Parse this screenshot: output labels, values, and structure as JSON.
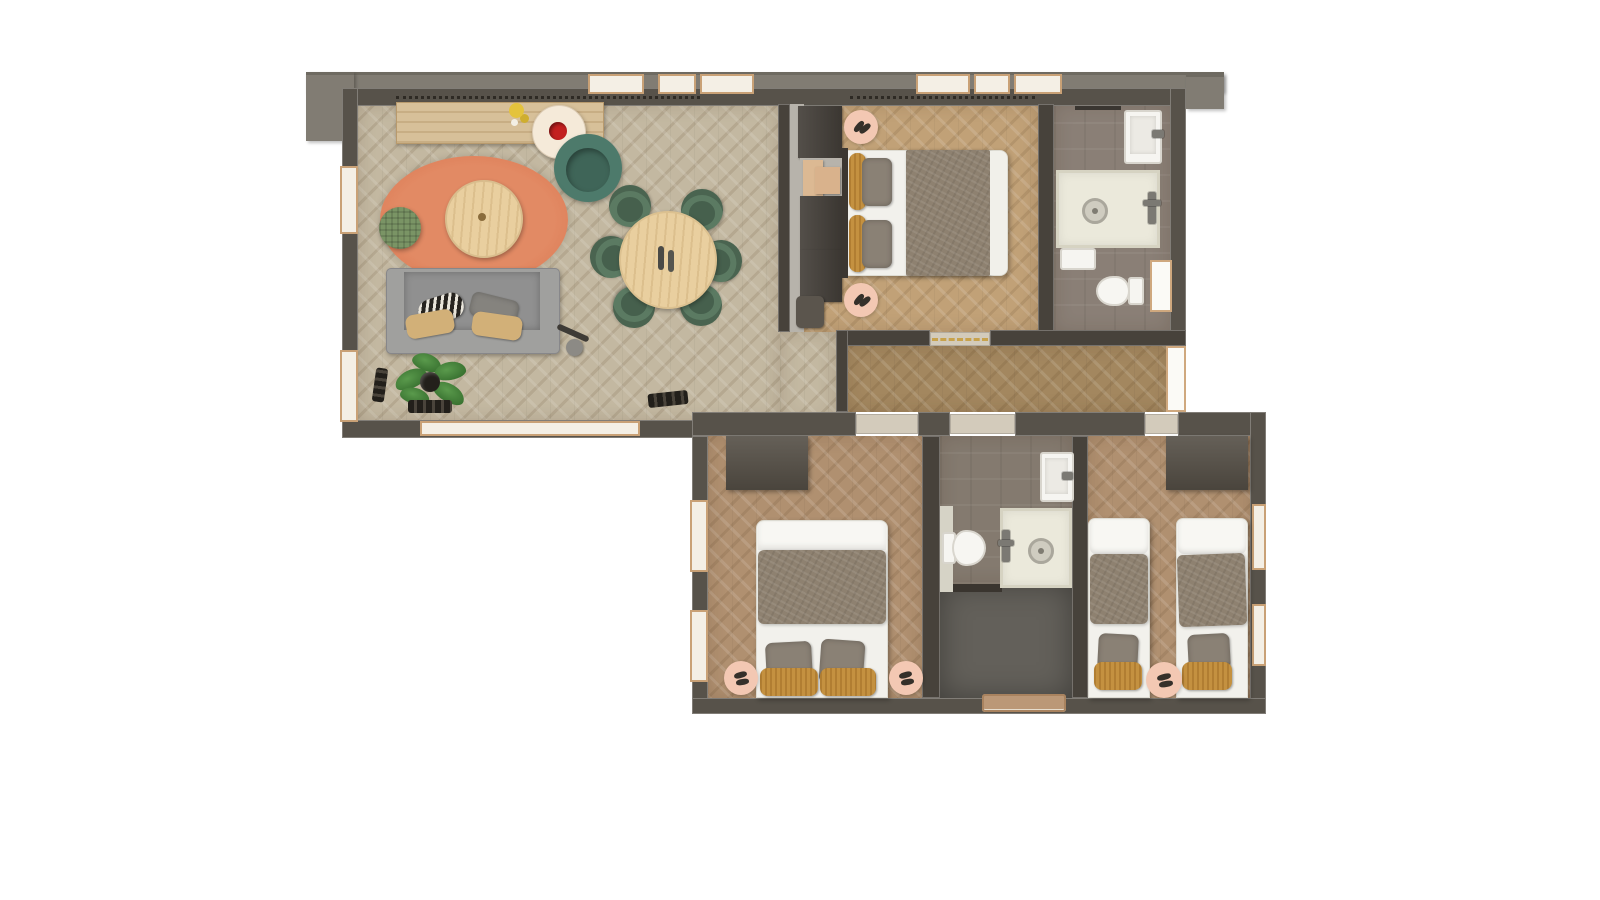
{
  "image_type": "3d-rendered-floor-plan-top-view",
  "visible_text": "none",
  "palette": {
    "background": "#ffffff",
    "wall": "#57524a",
    "roof_overhang": "#817c73",
    "floor_living": "#c3b8a1",
    "floor_master_bedroom": "#c1a177",
    "floor_hallway": "#a3875f",
    "floor_lower_bedrooms": "#b09070",
    "floor_bathrooms": "#8a7f76",
    "floor_entry_slate": "#63605a",
    "rug_terracotta": "#dd7c57",
    "rug_pink": "#f3c8b3",
    "chair_green": "#5b7a62",
    "armchair_teal": "#4d7a6b",
    "sofa_gray": "#9e9e9c",
    "wood_light": "#e9cf9f",
    "duvet_brown": "#8e8170",
    "pillow_gold": "#c49140",
    "fixtures_white": "#f6f5f1",
    "door_window_tan": "#c9a176"
  },
  "rooms": [
    {
      "name": "living-dining-room",
      "floor": "light-oak-herringbone",
      "furniture": [
        "tv-sideboard",
        "duck-decor",
        "side-table-with-red-bowl",
        "teal-armchair",
        "terracotta-oval-rug",
        "round-coffee-table",
        "green-pouf",
        "gray-sofa-with-pillows",
        "floor-lamp",
        "potted-plant",
        "shoes-by-wall",
        "round-dining-table-with-candles",
        "six-green-dining-chairs",
        "doormat-shoes"
      ]
    },
    {
      "name": "master-bedroom",
      "floor": "oak-herringbone",
      "furniture": [
        "wardrobe-column",
        "double-bed-white-and-brown",
        "gold-pillows",
        "gray-pillows",
        "pink-round-rug-with-slippers-top",
        "pink-round-rug-with-slippers-bottom"
      ]
    },
    {
      "name": "ensuite-bathroom",
      "floor": "gray-tile",
      "fixtures": [
        "vanity-sink",
        "walk-in-shower",
        "corner-basin",
        "toilet",
        "bathroom-door"
      ]
    },
    {
      "name": "hallway",
      "floor": "dark-oak-herringbone",
      "features": [
        "terrace-door-right"
      ]
    },
    {
      "name": "bedroom-2",
      "floor": "oak-herringbone",
      "furniture": [
        "wardrobe",
        "double-bed-white-and-brown",
        "two-gray-pillows",
        "two-gold-pillows",
        "pink-round-rug-left",
        "pink-round-rug-right",
        "two-windows-left-wall"
      ]
    },
    {
      "name": "family-bathroom",
      "floor": "gray-tile",
      "fixtures": [
        "wall-sink",
        "toilet",
        "walk-in-shower"
      ]
    },
    {
      "name": "entry-vestibule",
      "floor": "dark-slate",
      "features": [
        "entrance-door-bottom"
      ]
    },
    {
      "name": "twin-bedroom",
      "floor": "oak-herringbone",
      "furniture": [
        "wardrobe",
        "twin-bed-left",
        "twin-bed-right",
        "pink-round-rug-with-slippers",
        "two-windows-right-wall"
      ]
    }
  ],
  "windows": {
    "top_wall_count": 6,
    "left_wall_count": 2,
    "living_bottom_band": 1,
    "bedroom2_left_count": 2,
    "twin_right_count": 2
  }
}
